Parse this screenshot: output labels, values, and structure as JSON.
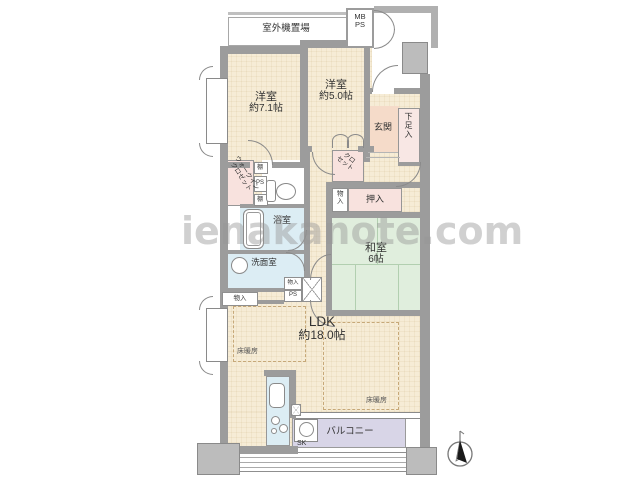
{
  "watermark": "ienakanote.com",
  "labels": {
    "outdoor_unit": "室外機置場",
    "mb": "MB",
    "ps": "PS",
    "western1_name": "洋室",
    "western1_size": "約7.1帖",
    "western2_name": "洋室",
    "western2_size": "約5.0帖",
    "entrance": "玄関",
    "shoe_cabinet": "下足入",
    "closet_line1": "クロ",
    "closet_line2": "セット",
    "wic_line1": "ウォークイン",
    "wic_line2": "クロゼット",
    "shelf": "棚",
    "bathroom": "浴室",
    "washroom": "洗面室",
    "storage": "物入",
    "oshiire": "押入",
    "japanese_name": "和室",
    "japanese_size": "6帖",
    "ldk_name": "LDK",
    "ldk_size": "約18.0帖",
    "floor_heating": "床暖房",
    "balcony": "バルコニー",
    "slop_sink": "SK"
  },
  "colors": {
    "room_beige": "#f6ecd6",
    "closet_pink": "#f8e2de",
    "entrance_peach": "#f5dbc9",
    "wet_area_blue": "#dcedf4",
    "tatami_green": "#e0eedd",
    "balcony_purple": "#d8d5e7",
    "wall_gray": "#9c9c9c",
    "watermark_gray": "#969696"
  }
}
